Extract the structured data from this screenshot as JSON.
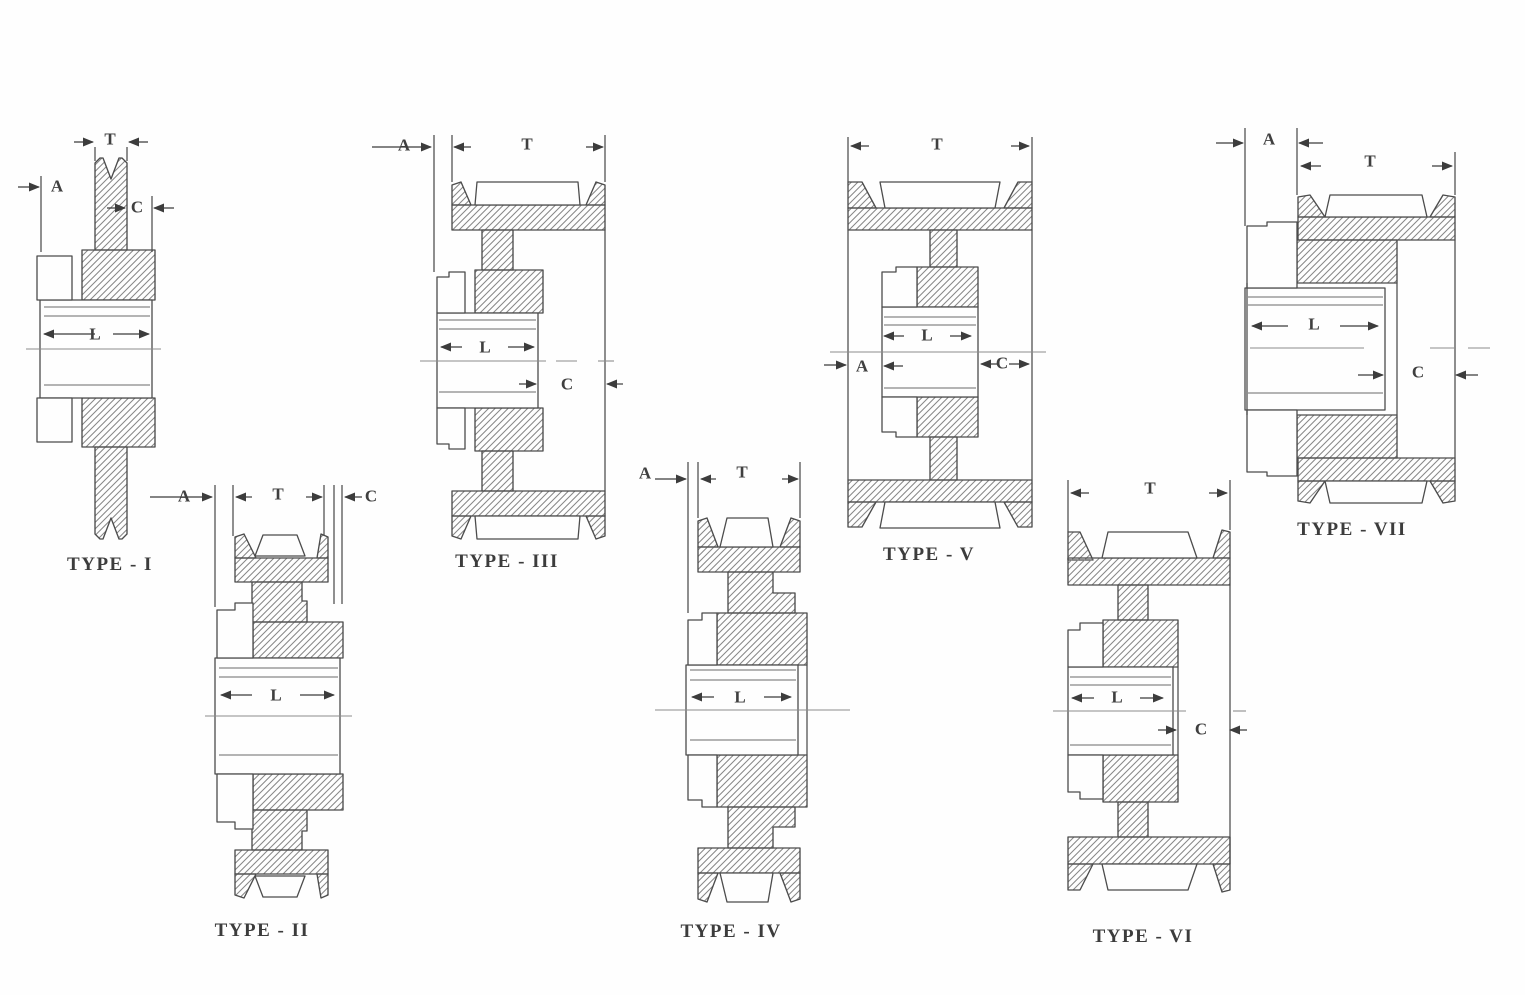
{
  "sheet": {
    "title": "V-belt sheave cross-section types",
    "colors": {
      "background": "#fefefe",
      "line": "#4c4c4c",
      "hatch": "#878787",
      "thin_line": "#6a6a6a",
      "centerline": "#8c8c8c",
      "text": "#3c3c3c"
    }
  },
  "diagrams": [
    {
      "id": "type-i",
      "caption": "TYPE - I",
      "dim_labels": {
        "T": "T",
        "A": "A",
        "C": "C",
        "L": "L"
      }
    },
    {
      "id": "type-ii",
      "caption": "TYPE - II",
      "dim_labels": {
        "A": "A",
        "T": "T",
        "C": "C",
        "L": "L"
      }
    },
    {
      "id": "type-iii",
      "caption": "TYPE - III",
      "dim_labels": {
        "A": "A",
        "T": "T",
        "L": "L",
        "C": "C"
      }
    },
    {
      "id": "type-iv",
      "caption": "TYPE - IV",
      "dim_labels": {
        "A": "A",
        "T": "T",
        "L": "L"
      }
    },
    {
      "id": "type-v",
      "caption": "TYPE - V",
      "dim_labels": {
        "T": "T",
        "L": "L",
        "A": "A",
        "C": "C"
      }
    },
    {
      "id": "type-vi",
      "caption": "TYPE - VI",
      "dim_labels": {
        "T": "T",
        "L": "L",
        "C": "C"
      }
    },
    {
      "id": "type-vii",
      "caption": "TYPE - VII",
      "dim_labels": {
        "A": "A",
        "T": "T",
        "L": "L",
        "C": "C"
      }
    }
  ]
}
